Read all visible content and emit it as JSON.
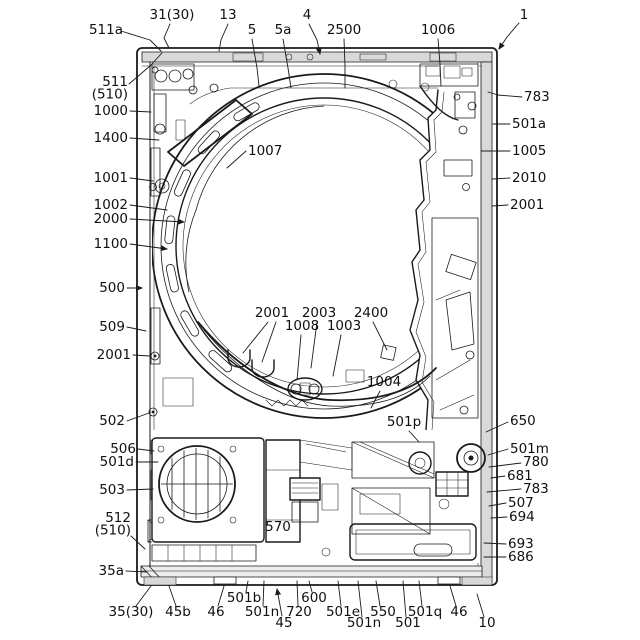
{
  "colors": {
    "ink": "#1a1a1a",
    "panel_gray": "#d9d9d9",
    "light_gray": "#ededed",
    "background": "#ffffff"
  },
  "labels": [
    {
      "id": "ref-511a",
      "text": "511a",
      "x": 106,
      "y": 34,
      "anchor": "middle",
      "leaders": [
        [
          [
            121,
            31
          ],
          [
            150,
            40
          ],
          [
            161,
            51
          ]
        ]
      ]
    },
    {
      "id": "ref-31-30",
      "text": "31(30)",
      "x": 172,
      "y": 19,
      "anchor": "middle",
      "leaders": [
        [
          [
            170,
            24
          ],
          [
            164,
            38
          ],
          [
            169,
            48
          ]
        ]
      ]
    },
    {
      "id": "ref-13",
      "text": "13",
      "x": 228,
      "y": 19,
      "anchor": "middle",
      "leaders": [
        [
          [
            228,
            24
          ],
          [
            221,
            40
          ],
          [
            219,
            51
          ]
        ]
      ]
    },
    {
      "id": "ref-5",
      "text": "5",
      "x": 252,
      "y": 34,
      "anchor": "middle",
      "leaders": [
        [
          [
            252,
            39
          ],
          [
            257,
            68
          ],
          [
            259,
            86
          ]
        ]
      ]
    },
    {
      "id": "ref-5a",
      "text": "5a",
      "x": 283,
      "y": 34,
      "anchor": "middle",
      "leaders": [
        [
          [
            283,
            39
          ],
          [
            288,
            68
          ],
          [
            291,
            88
          ]
        ]
      ]
    },
    {
      "id": "ref-4",
      "text": "4",
      "x": 307,
      "y": 19,
      "anchor": "middle",
      "leaders": [
        [
          [
            309,
            24
          ],
          [
            317,
            40
          ],
          [
            320,
            54
          ]
        ]
      ],
      "arrow": true
    },
    {
      "id": "ref-2500",
      "text": "2500",
      "x": 344,
      "y": 34,
      "anchor": "middle",
      "leaders": [
        [
          [
            344,
            39
          ],
          [
            345,
            66
          ],
          [
            345,
            88
          ]
        ]
      ]
    },
    {
      "id": "ref-1006",
      "text": "1006",
      "x": 438,
      "y": 34,
      "anchor": "middle",
      "leaders": [
        [
          [
            438,
            39
          ],
          [
            440,
            64
          ],
          [
            441,
            86
          ]
        ]
      ]
    },
    {
      "id": "ref-1",
      "text": "1",
      "x": 524,
      "y": 19,
      "anchor": "middle",
      "leaders": [
        [
          [
            519,
            23
          ],
          [
            507,
            37
          ],
          [
            499,
            49
          ]
        ]
      ],
      "arrow": true
    },
    {
      "id": "ref-511-510",
      "lines": [
        "511",
        "(510)"
      ],
      "x": 128,
      "y": 86,
      "anchor": "end",
      "leaders": [
        [
          [
            129,
            84
          ],
          [
            150,
            66
          ],
          [
            162,
            53
          ]
        ]
      ]
    },
    {
      "id": "ref-1000",
      "text": "1000",
      "x": 128,
      "y": 115,
      "anchor": "end",
      "leaders": [
        [
          [
            130,
            111
          ],
          [
            151,
            112
          ]
        ]
      ]
    },
    {
      "id": "ref-1400",
      "text": "1400",
      "x": 128,
      "y": 142,
      "anchor": "end",
      "leaders": [
        [
          [
            130,
            138
          ],
          [
            159,
            140
          ]
        ]
      ]
    },
    {
      "id": "ref-1001",
      "text": "1001",
      "x": 128,
      "y": 182,
      "anchor": "end",
      "leaders": [
        [
          [
            130,
            178
          ],
          [
            153,
            181
          ]
        ]
      ]
    },
    {
      "id": "ref-1002",
      "text": "1002",
      "x": 128,
      "y": 209,
      "anchor": "end",
      "leaders": [
        [
          [
            130,
            205
          ],
          [
            167,
            210
          ]
        ]
      ]
    },
    {
      "id": "ref-2000",
      "text": "2000",
      "x": 128,
      "y": 223,
      "anchor": "end",
      "leaders": [
        [
          [
            130,
            219
          ],
          [
            184,
            222
          ]
        ]
      ],
      "arrow": true
    },
    {
      "id": "ref-1100",
      "text": "1100",
      "x": 128,
      "y": 248,
      "anchor": "end",
      "leaders": [
        [
          [
            130,
            244
          ],
          [
            167,
            249
          ]
        ]
      ],
      "arrow": true
    },
    {
      "id": "ref-500",
      "text": "500",
      "x": 125,
      "y": 292,
      "anchor": "end",
      "leaders": [
        [
          [
            127,
            288
          ],
          [
            142,
            288
          ]
        ]
      ],
      "arrow": true
    },
    {
      "id": "ref-509",
      "text": "509",
      "x": 125,
      "y": 331,
      "anchor": "end",
      "leaders": [
        [
          [
            127,
            327
          ],
          [
            146,
            331
          ]
        ]
      ]
    },
    {
      "id": "ref-2001-l",
      "text": "2001",
      "x": 131,
      "y": 359,
      "anchor": "end",
      "leaders": [
        [
          [
            133,
            355
          ],
          [
            150,
            356
          ]
        ]
      ]
    },
    {
      "id": "ref-502",
      "text": "502",
      "x": 125,
      "y": 425,
      "anchor": "end",
      "leaders": [
        [
          [
            127,
            421
          ],
          [
            149,
            413
          ]
        ]
      ]
    },
    {
      "id": "ref-506",
      "text": "506",
      "x": 136,
      "y": 453,
      "anchor": "end",
      "leaders": [
        [
          [
            138,
            449
          ],
          [
            154,
            451
          ]
        ]
      ]
    },
    {
      "id": "ref-501d",
      "text": "501d",
      "x": 134,
      "y": 466,
      "anchor": "end",
      "leaders": [
        [
          [
            136,
            462
          ],
          [
            158,
            462
          ]
        ]
      ]
    },
    {
      "id": "ref-503",
      "text": "503",
      "x": 125,
      "y": 494,
      "anchor": "end",
      "leaders": [
        [
          [
            127,
            490
          ],
          [
            153,
            489
          ]
        ]
      ]
    },
    {
      "id": "ref-512-510",
      "lines": [
        "512",
        "(510)"
      ],
      "x": 131,
      "y": 522,
      "anchor": "end",
      "leaders": [
        [
          [
            131,
            536
          ],
          [
            145,
            549
          ]
        ]
      ]
    },
    {
      "id": "ref-35a",
      "text": "35a",
      "x": 124,
      "y": 575,
      "anchor": "end",
      "leaders": [
        [
          [
            126,
            571
          ],
          [
            147,
            572
          ]
        ]
      ]
    },
    {
      "id": "ref-35-30",
      "text": "35(30)",
      "x": 131,
      "y": 616,
      "anchor": "middle",
      "leaders": [
        [
          [
            136,
            606
          ],
          [
            151,
            586
          ]
        ]
      ]
    },
    {
      "id": "ref-45b",
      "text": "45b",
      "x": 178,
      "y": 616,
      "anchor": "middle",
      "leaders": [
        [
          [
            176,
            606
          ],
          [
            169,
            586
          ]
        ]
      ]
    },
    {
      "id": "ref-46-l",
      "text": "46",
      "x": 216,
      "y": 616,
      "anchor": "middle",
      "leaders": [
        [
          [
            218,
            606
          ],
          [
            224,
            586
          ]
        ]
      ]
    },
    {
      "id": "ref-501b",
      "text": "501b",
      "x": 244,
      "y": 602,
      "anchor": "middle",
      "leaders": [
        [
          [
            246,
            592
          ],
          [
            248,
            581
          ]
        ]
      ]
    },
    {
      "id": "ref-501n-1",
      "text": "501n",
      "x": 262,
      "y": 616,
      "anchor": "middle",
      "leaders": [
        [
          [
            263,
            606
          ],
          [
            264,
            581
          ]
        ]
      ]
    },
    {
      "id": "ref-45",
      "text": "45",
      "x": 284,
      "y": 627,
      "anchor": "middle",
      "leaders": [
        [
          [
            282,
            616
          ],
          [
            277,
            589
          ]
        ]
      ],
      "arrow": true
    },
    {
      "id": "ref-720",
      "text": "720",
      "x": 299,
      "y": 616,
      "anchor": "middle",
      "leaders": [
        [
          [
            298,
            606
          ],
          [
            297,
            581
          ]
        ]
      ]
    },
    {
      "id": "ref-600",
      "text": "600",
      "x": 314,
      "y": 602,
      "anchor": "middle",
      "leaders": [
        [
          [
            312,
            592
          ],
          [
            309,
            581
          ]
        ]
      ]
    },
    {
      "id": "ref-501e",
      "text": "501e",
      "x": 343,
      "y": 616,
      "anchor": "middle",
      "leaders": [
        [
          [
            341,
            606
          ],
          [
            338,
            581
          ]
        ]
      ]
    },
    {
      "id": "ref-501n-2",
      "text": "501n",
      "x": 364,
      "y": 627,
      "anchor": "middle",
      "leaders": [
        [
          [
            362,
            617
          ],
          [
            358,
            581
          ]
        ]
      ]
    },
    {
      "id": "ref-550",
      "text": "550",
      "x": 383,
      "y": 616,
      "anchor": "middle",
      "leaders": [
        [
          [
            380,
            606
          ],
          [
            376,
            581
          ]
        ]
      ]
    },
    {
      "id": "ref-501",
      "text": "501",
      "x": 408,
      "y": 627,
      "anchor": "middle",
      "leaders": [
        [
          [
            406,
            617
          ],
          [
            403,
            581
          ]
        ]
      ]
    },
    {
      "id": "ref-501q",
      "text": "501q",
      "x": 425,
      "y": 616,
      "anchor": "middle",
      "leaders": [
        [
          [
            422,
            606
          ],
          [
            419,
            581
          ]
        ]
      ]
    },
    {
      "id": "ref-46-r",
      "text": "46",
      "x": 459,
      "y": 616,
      "anchor": "middle",
      "leaders": [
        [
          [
            456,
            606
          ],
          [
            450,
            586
          ]
        ]
      ]
    },
    {
      "id": "ref-10",
      "text": "10",
      "x": 487,
      "y": 627,
      "anchor": "middle",
      "leaders": [
        [
          [
            484,
            617
          ],
          [
            477,
            594
          ]
        ]
      ]
    },
    {
      "id": "ref-783-t",
      "text": "783",
      "x": 524,
      "y": 101,
      "anchor": "start",
      "leaders": [
        [
          [
            522,
            97
          ],
          [
            498,
            95
          ],
          [
            488,
            92
          ]
        ]
      ]
    },
    {
      "id": "ref-501a",
      "text": "501a",
      "x": 512,
      "y": 128,
      "anchor": "start",
      "leaders": [
        [
          [
            510,
            124
          ],
          [
            493,
            124
          ]
        ]
      ]
    },
    {
      "id": "ref-1005",
      "text": "1005",
      "x": 512,
      "y": 155,
      "anchor": "start",
      "leaders": [
        [
          [
            510,
            151
          ],
          [
            481,
            151
          ]
        ]
      ]
    },
    {
      "id": "ref-2010",
      "text": "2010",
      "x": 512,
      "y": 182,
      "anchor": "start",
      "leaders": [
        [
          [
            510,
            178
          ],
          [
            492,
            179
          ]
        ]
      ]
    },
    {
      "id": "ref-2001-r",
      "text": "2001",
      "x": 510,
      "y": 209,
      "anchor": "start",
      "leaders": [
        [
          [
            508,
            205
          ],
          [
            492,
            206
          ]
        ]
      ]
    },
    {
      "id": "ref-650",
      "text": "650",
      "x": 510,
      "y": 425,
      "anchor": "start",
      "leaders": [
        [
          [
            508,
            422
          ],
          [
            486,
            432
          ]
        ]
      ]
    },
    {
      "id": "ref-501m",
      "text": "501m",
      "x": 510,
      "y": 453,
      "anchor": "start",
      "leaders": [
        [
          [
            508,
            449
          ],
          [
            488,
            455
          ]
        ]
      ]
    },
    {
      "id": "ref-780",
      "text": "780",
      "x": 523,
      "y": 466,
      "anchor": "start",
      "leaders": [
        [
          [
            521,
            463
          ],
          [
            489,
            467
          ]
        ]
      ]
    },
    {
      "id": "ref-681",
      "text": "681",
      "x": 507,
      "y": 480,
      "anchor": "start",
      "leaders": [
        [
          [
            505,
            476
          ],
          [
            491,
            478
          ]
        ]
      ]
    },
    {
      "id": "ref-783-b",
      "text": "783",
      "x": 523,
      "y": 493,
      "anchor": "start",
      "leaders": [
        [
          [
            521,
            489
          ],
          [
            487,
            492
          ]
        ]
      ]
    },
    {
      "id": "ref-507",
      "text": "507",
      "x": 508,
      "y": 507,
      "anchor": "start",
      "leaders": [
        [
          [
            506,
            503
          ],
          [
            489,
            506
          ]
        ]
      ]
    },
    {
      "id": "ref-694",
      "text": "694",
      "x": 509,
      "y": 521,
      "anchor": "start",
      "leaders": [
        [
          [
            507,
            517
          ],
          [
            491,
            518
          ]
        ]
      ]
    },
    {
      "id": "ref-693",
      "text": "693",
      "x": 508,
      "y": 548,
      "anchor": "start",
      "leaders": [
        [
          [
            506,
            544
          ],
          [
            484,
            543
          ]
        ]
      ]
    },
    {
      "id": "ref-686",
      "text": "686",
      "x": 508,
      "y": 561,
      "anchor": "start",
      "leaders": [
        [
          [
            506,
            557
          ],
          [
            484,
            557
          ]
        ]
      ]
    },
    {
      "id": "ref-1007",
      "text": "1007",
      "x": 248,
      "y": 155,
      "anchor": "start",
      "leaders": [
        [
          [
            246,
            151
          ],
          [
            227,
            168
          ]
        ]
      ]
    },
    {
      "id": "ref-2001-c",
      "text": "2001",
      "x": 272,
      "y": 317,
      "anchor": "middle",
      "leaders": [
        [
          [
            268,
            322
          ],
          [
            243,
            353
          ]
        ],
        [
          [
            276,
            322
          ],
          [
            262,
            362
          ]
        ]
      ]
    },
    {
      "id": "ref-2003",
      "text": "2003",
      "x": 319,
      "y": 317,
      "anchor": "middle",
      "leaders": [
        [
          [
            317,
            322
          ],
          [
            311,
            368
          ]
        ]
      ]
    },
    {
      "id": "ref-1008",
      "text": "1008",
      "x": 302,
      "y": 330,
      "anchor": "middle",
      "leaders": [
        [
          [
            301,
            335
          ],
          [
            297,
            380
          ]
        ]
      ]
    },
    {
      "id": "ref-1003",
      "text": "1003",
      "x": 344,
      "y": 330,
      "anchor": "middle",
      "leaders": [
        [
          [
            341,
            335
          ],
          [
            333,
            376
          ]
        ]
      ]
    },
    {
      "id": "ref-2400",
      "text": "2400",
      "x": 371,
      "y": 317,
      "anchor": "middle",
      "leaders": [
        [
          [
            373,
            322
          ],
          [
            387,
            350
          ]
        ]
      ]
    },
    {
      "id": "ref-1004",
      "text": "1004",
      "x": 384,
      "y": 386,
      "anchor": "middle",
      "leaders": [
        [
          [
            380,
            391
          ],
          [
            371,
            408
          ]
        ]
      ]
    },
    {
      "id": "ref-501p",
      "text": "501p",
      "x": 404,
      "y": 426,
      "anchor": "middle",
      "leaders": [
        [
          [
            409,
            431
          ],
          [
            419,
            442
          ]
        ]
      ]
    },
    {
      "id": "ref-570",
      "text": "570",
      "x": 278,
      "y": 531,
      "anchor": "middle",
      "leaders": []
    }
  ]
}
